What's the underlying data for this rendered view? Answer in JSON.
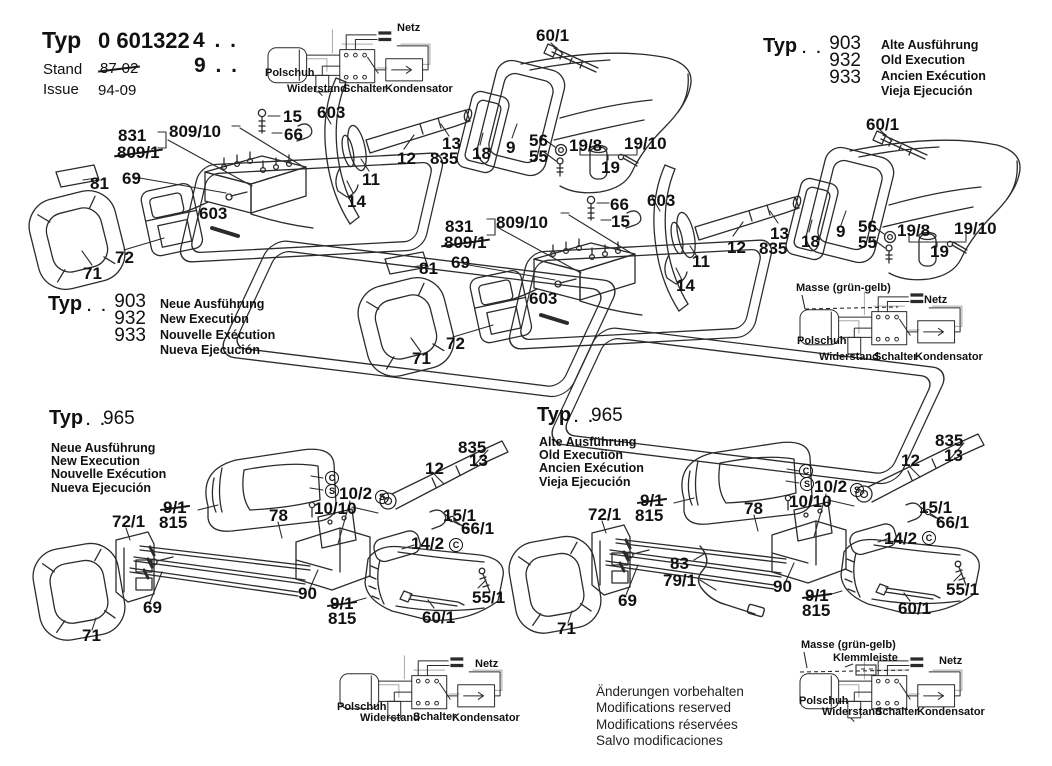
{
  "colors": {
    "ink": "#2b2b2b",
    "bg": "#ffffff",
    "echo": "#a8a8a8"
  },
  "title_block": {
    "typ_label": "Typ",
    "model_prefix": "0 601",
    "model_bold": "322",
    "model_suffix": "4 . .",
    "model_suffix2": "9 . .",
    "stand_label": "Stand",
    "stand_value": "87-02",
    "issue_label": "Issue",
    "issue_value": "94-09"
  },
  "variant_blocks": {
    "top_right": {
      "typ": "Typ",
      "dots": ". .",
      "models": [
        "903",
        "932",
        "933"
      ],
      "langs": [
        "Alte Ausführung",
        "Old Execution",
        "Ancien Exécution",
        "Vieja Ejecución"
      ]
    },
    "mid_left": {
      "typ": "Typ",
      "dots": ". .",
      "models": [
        "903",
        "932",
        "933"
      ],
      "langs": [
        "Neue Ausführung",
        "New Execution",
        "Nouvelle Exécution",
        "Nueva Ejecución"
      ]
    },
    "bottom_left": {
      "typ": "Typ",
      "dots": ". .",
      "models": [
        "965"
      ],
      "langs": [
        "Neue Ausführung",
        "New Execution",
        "Nouvelle Exécution",
        "Nueva Ejecución"
      ]
    },
    "bottom_mid": {
      "typ": "Typ",
      "dots": ". .",
      "models": [
        "965"
      ],
      "langs": [
        "Alte Ausführung",
        "Old Execution",
        "Ancien Exécution",
        "Vieja Ejecución"
      ]
    }
  },
  "footer": {
    "lines": [
      "Änderungen vorbehalten",
      "Modifications reserved",
      "Modifications réservées",
      "Salvo modificaciones"
    ]
  },
  "annotations": {
    "upper_left": [
      {
        "t": "60/1",
        "x": 536,
        "y": 27
      },
      {
        "t": "831",
        "x": 118,
        "y": 127
      },
      {
        "t": "809/1",
        "x": 117,
        "y": 144,
        "strike": 1
      },
      {
        "t": "809/10",
        "x": 169,
        "y": 123
      },
      {
        "t": "15",
        "x": 283,
        "y": 108
      },
      {
        "t": "66",
        "x": 284,
        "y": 126
      },
      {
        "t": "603",
        "x": 317,
        "y": 104
      },
      {
        "t": "12",
        "x": 397,
        "y": 150
      },
      {
        "t": "13",
        "x": 442,
        "y": 135
      },
      {
        "t": "835",
        "x": 430,
        "y": 150
      },
      {
        "t": "18",
        "x": 472,
        "y": 145
      },
      {
        "t": "9",
        "x": 506,
        "y": 139
      },
      {
        "t": "56",
        "x": 529,
        "y": 132
      },
      {
        "t": "55",
        "x": 529,
        "y": 148
      },
      {
        "t": "19/8",
        "x": 569,
        "y": 137
      },
      {
        "t": "19/10",
        "x": 624,
        "y": 135
      },
      {
        "t": "19",
        "x": 601,
        "y": 159
      },
      {
        "t": "81",
        "x": 90,
        "y": 175
      },
      {
        "t": "69",
        "x": 122,
        "y": 170
      },
      {
        "t": "603",
        "x": 199,
        "y": 205
      },
      {
        "t": "11",
        "x": 362,
        "y": 171
      },
      {
        "t": "14",
        "x": 347,
        "y": 193
      },
      {
        "t": "72",
        "x": 115,
        "y": 249
      },
      {
        "t": "71",
        "x": 83,
        "y": 265
      }
    ],
    "upper_right": [
      {
        "t": "60/1",
        "x": 866,
        "y": 116
      },
      {
        "t": "831",
        "x": 445,
        "y": 218
      },
      {
        "t": "809/1",
        "x": 444,
        "y": 234,
        "strike": 1
      },
      {
        "t": "809/10",
        "x": 496,
        "y": 214
      },
      {
        "t": "66",
        "x": 610,
        "y": 196
      },
      {
        "t": "15",
        "x": 611,
        "y": 213
      },
      {
        "t": "603",
        "x": 647,
        "y": 192
      },
      {
        "t": "12",
        "x": 727,
        "y": 239
      },
      {
        "t": "13",
        "x": 770,
        "y": 225
      },
      {
        "t": "835",
        "x": 759,
        "y": 240
      },
      {
        "t": "18",
        "x": 801,
        "y": 233
      },
      {
        "t": "9",
        "x": 836,
        "y": 223
      },
      {
        "t": "56",
        "x": 858,
        "y": 218
      },
      {
        "t": "55",
        "x": 858,
        "y": 234
      },
      {
        "t": "19/8",
        "x": 897,
        "y": 222
      },
      {
        "t": "19/10",
        "x": 954,
        "y": 220
      },
      {
        "t": "19",
        "x": 930,
        "y": 243
      },
      {
        "t": "81",
        "x": 419,
        "y": 260
      },
      {
        "t": "69",
        "x": 451,
        "y": 254
      },
      {
        "t": "603",
        "x": 529,
        "y": 290
      },
      {
        "t": "11",
        "x": 692,
        "y": 253
      },
      {
        "t": "14",
        "x": 676,
        "y": 277
      },
      {
        "t": "72",
        "x": 446,
        "y": 335
      },
      {
        "t": "71",
        "x": 412,
        "y": 350
      }
    ],
    "lower_left": [
      {
        "t": "9/1",
        "x": 163,
        "y": 499,
        "strike": 1
      },
      {
        "t": "815",
        "x": 159,
        "y": 514
      },
      {
        "t": "72/1",
        "x": 112,
        "y": 513
      },
      {
        "t": "78",
        "x": 269,
        "y": 507
      },
      {
        "t": "10/10",
        "x": 314,
        "y": 500
      },
      {
        "t": "10/2",
        "x": 339,
        "y": 485
      },
      {
        "t": "S",
        "x": 375,
        "y": 490,
        "k": "circ"
      },
      {
        "t": "C",
        "x": 325,
        "y": 471,
        "k": "circ"
      },
      {
        "t": "S",
        "x": 325,
        "y": 484,
        "k": "circ"
      },
      {
        "t": "69",
        "x": 143,
        "y": 599
      },
      {
        "t": "71",
        "x": 82,
        "y": 627
      },
      {
        "t": "90",
        "x": 298,
        "y": 585
      },
      {
        "t": "9/1",
        "x": 330,
        "y": 595,
        "strike": 1
      },
      {
        "t": "815",
        "x": 328,
        "y": 610
      },
      {
        "t": "835",
        "x": 458,
        "y": 439
      },
      {
        "t": "13",
        "x": 469,
        "y": 452
      },
      {
        "t": "12",
        "x": 425,
        "y": 460
      },
      {
        "t": "15/1",
        "x": 443,
        "y": 507
      },
      {
        "t": "66/1",
        "x": 461,
        "y": 520
      },
      {
        "t": "14/2",
        "x": 411,
        "y": 535
      },
      {
        "t": "C",
        "x": 449,
        "y": 538,
        "k": "circ"
      },
      {
        "t": "55/1",
        "x": 472,
        "y": 589
      },
      {
        "t": "60/1",
        "x": 422,
        "y": 609
      }
    ],
    "lower_mid": [
      {
        "t": "9/1",
        "x": 640,
        "y": 492,
        "strike": 1
      },
      {
        "t": "815",
        "x": 635,
        "y": 507
      },
      {
        "t": "72/1",
        "x": 588,
        "y": 506
      },
      {
        "t": "78",
        "x": 744,
        "y": 500
      },
      {
        "t": "10/10",
        "x": 789,
        "y": 493
      },
      {
        "t": "10/2",
        "x": 814,
        "y": 478
      },
      {
        "t": "S",
        "x": 850,
        "y": 483,
        "k": "circ"
      },
      {
        "t": "C",
        "x": 799,
        "y": 464,
        "k": "circ"
      },
      {
        "t": "S",
        "x": 800,
        "y": 477,
        "k": "circ"
      },
      {
        "t": "83",
        "x": 670,
        "y": 555
      },
      {
        "t": "79/1",
        "x": 663,
        "y": 572
      },
      {
        "t": "69",
        "x": 618,
        "y": 592
      },
      {
        "t": "71",
        "x": 557,
        "y": 620
      },
      {
        "t": "90",
        "x": 773,
        "y": 578
      },
      {
        "t": "9/1",
        "x": 805,
        "y": 587,
        "strike": 1
      },
      {
        "t": "815",
        "x": 802,
        "y": 602
      },
      {
        "t": "835",
        "x": 935,
        "y": 432
      },
      {
        "t": "13",
        "x": 944,
        "y": 447
      },
      {
        "t": "12",
        "x": 901,
        "y": 452
      },
      {
        "t": "15/1",
        "x": 919,
        "y": 499
      },
      {
        "t": "66/1",
        "x": 936,
        "y": 514
      },
      {
        "t": "14/2",
        "x": 884,
        "y": 530
      },
      {
        "t": "C",
        "x": 922,
        "y": 531,
        "k": "circ"
      },
      {
        "t": "55/1",
        "x": 946,
        "y": 581
      },
      {
        "t": "60/1",
        "x": 898,
        "y": 600
      }
    ],
    "wiring": [
      {
        "t": "Netz",
        "x": 397,
        "y": 23,
        "k": "wire"
      },
      {
        "t": "Polschuh",
        "x": 265,
        "y": 68,
        "k": "wire"
      },
      {
        "t": "Widerstand",
        "x": 287,
        "y": 84,
        "k": "wire"
      },
      {
        "t": "Schalter",
        "x": 343,
        "y": 84,
        "k": "wire"
      },
      {
        "t": "Kondensator",
        "x": 385,
        "y": 84,
        "k": "wire"
      },
      {
        "t": "Masse (grün-gelb)",
        "x": 796,
        "y": 283,
        "k": "wire"
      },
      {
        "t": "Netz",
        "x": 924,
        "y": 295,
        "k": "wire"
      },
      {
        "t": "Polschuh",
        "x": 797,
        "y": 336,
        "k": "wire"
      },
      {
        "t": "Widerstand",
        "x": 819,
        "y": 352,
        "k": "wire"
      },
      {
        "t": "Schalter",
        "x": 874,
        "y": 352,
        "k": "wire"
      },
      {
        "t": "Kondensator",
        "x": 915,
        "y": 352,
        "k": "wire"
      },
      {
        "t": "Netz",
        "x": 475,
        "y": 659,
        "k": "wire"
      },
      {
        "t": "Polschuh",
        "x": 337,
        "y": 702,
        "k": "wire"
      },
      {
        "t": "Widerstand",
        "x": 360,
        "y": 713,
        "k": "wire"
      },
      {
        "t": "Schalter",
        "x": 413,
        "y": 712,
        "k": "wire"
      },
      {
        "t": "Kondensator",
        "x": 452,
        "y": 713,
        "k": "wire"
      },
      {
        "t": "Masse (grün-gelb)",
        "x": 801,
        "y": 640,
        "k": "wire"
      },
      {
        "t": "Klemmleiste",
        "x": 833,
        "y": 653,
        "k": "wire"
      },
      {
        "t": "Netz",
        "x": 939,
        "y": 656,
        "k": "wire"
      },
      {
        "t": "Polschuh",
        "x": 799,
        "y": 696,
        "k": "wire"
      },
      {
        "t": "Widerstand",
        "x": 822,
        "y": 707,
        "k": "wire"
      },
      {
        "t": "Schalter",
        "x": 875,
        "y": 707,
        "k": "wire"
      },
      {
        "t": "Kondensator",
        "x": 917,
        "y": 707,
        "k": "wire"
      }
    ]
  }
}
